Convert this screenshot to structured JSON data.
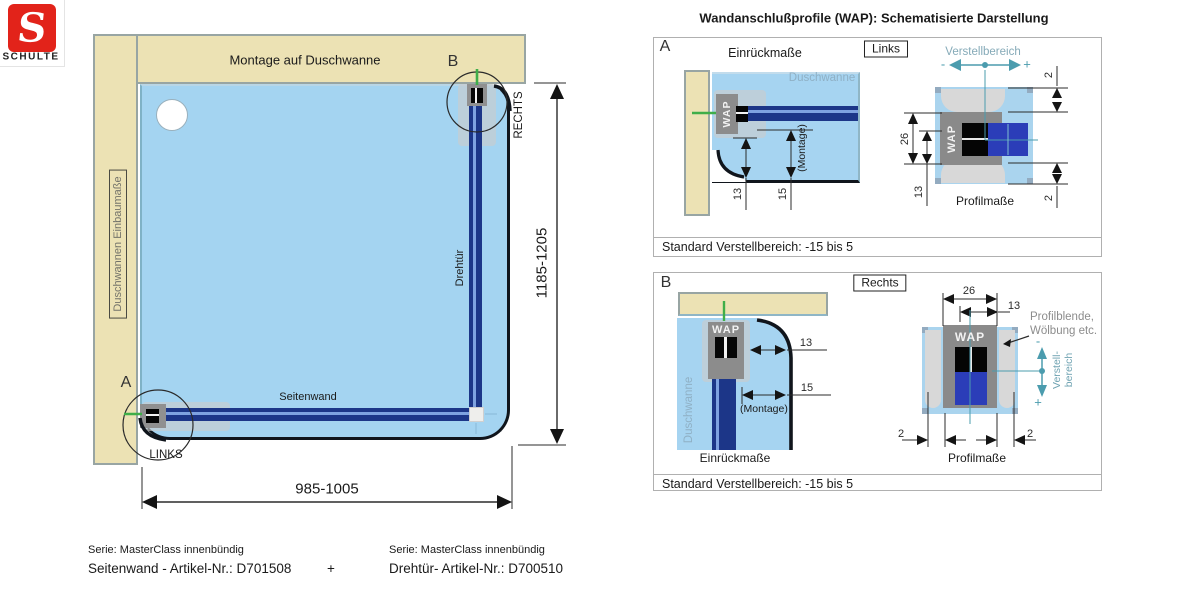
{
  "logo": {
    "letter": "S",
    "brand": "SCHULTE"
  },
  "main": {
    "top_wall_label": "Montage auf Duschwanne",
    "left_wall_label": "Duschwannen Einbaumaße",
    "point_a": "A",
    "point_b": "B",
    "links": "LINKS",
    "rechts": "RECHTS",
    "door": "Drehtür",
    "side_wall": "Seitenwand",
    "width": "985-1005",
    "height": "1185-1205"
  },
  "wap": {
    "title": "Wandanschlußprofile (WAP): Schematisierte Darstellung",
    "a": {
      "letter": "A",
      "tag": "Links",
      "einrueckmasse": "Einrückmaße",
      "profilmasse": "Profilmaße",
      "verstellbereich": "Verstellbereich",
      "minus": "-",
      "plus": "+",
      "duschwanne": "Duschwanne",
      "wap_left": "WAP",
      "wap_right": "WAP",
      "montage": "(Montage)",
      "dim13_left": "13",
      "dim15_left": "15",
      "dim26": "26",
      "dim13_right": "13",
      "dim2_top": "2",
      "dim2_bottom": "2",
      "note": "Standard Verstellbereich: -15 bis 5"
    },
    "b": {
      "letter": "B",
      "tag": "Rechts",
      "einrueckmasse": "Einrückmaße",
      "profilmasse": "Profilmaße",
      "verstell_line1": "Verstell-",
      "verstell_line2": "bereich",
      "minus": "-",
      "plus": "+",
      "duschwanne": "Duschwanne",
      "wap_left": "WAP",
      "wap_right": "WAP",
      "montage": "(Montage)",
      "dim13_left": "13",
      "dim15_left": "15",
      "dim26": "26",
      "dim13_right": "13",
      "dim2_left": "2",
      "dim2_right": "2",
      "profilblende_line1": "Profilblende,",
      "profilblende_line2": "Wölbung etc.",
      "note": "Standard Verstellbereich: -15 bis 5"
    }
  },
  "footer": {
    "left_serie": "Serie: MasterClass innenbündig",
    "left_article": "Seitenwand - Artikel-Nr.: D701508",
    "plus": "+",
    "right_serie": "Serie: MasterClass innenbündig",
    "right_article": "Drehtür- Artikel-Nr.: D700510"
  },
  "colors": {
    "brand_red": "#e2231a",
    "wall_beige": "#ece2b4",
    "tray_blue": "#a4d4f1",
    "glass_blue": "#1c3688",
    "profile_gray": "#8c8c8c",
    "accent_teal": "#4b9cae",
    "marker_green": "#3fae49",
    "label_bluegray": "#8fb0c5"
  }
}
